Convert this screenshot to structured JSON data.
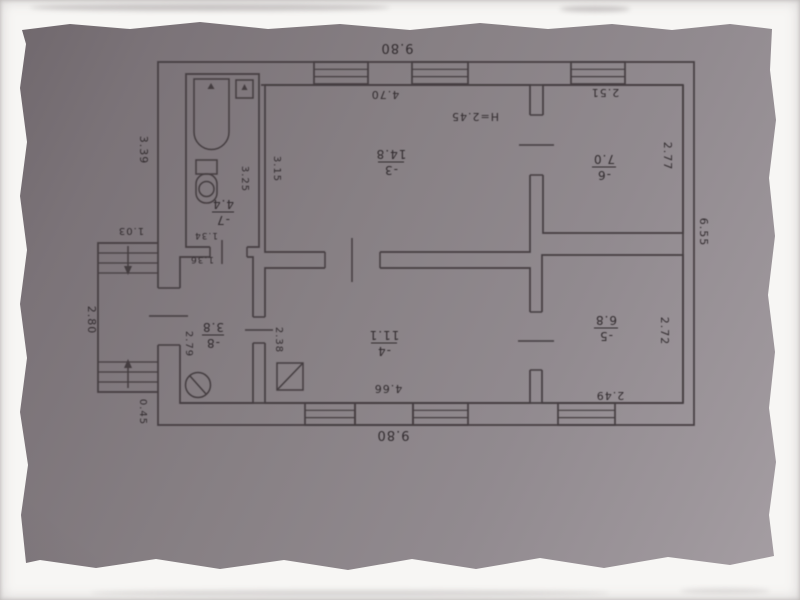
{
  "photo": {
    "border_color": "#f7f6f4",
    "paper_color": "#8a8287",
    "ink_color": "#453e41"
  },
  "floorplan": {
    "height_note": "H=2.45",
    "outer_dimensions": {
      "top": "9.80",
      "bottom": "9.80",
      "right": "6.55",
      "left": "3.39"
    },
    "porch": {
      "width": "1.03",
      "depth": "2.80",
      "step": "0.45"
    },
    "rooms": [
      {
        "number": "-3",
        "area": "14.8",
        "width": "4.70",
        "depth": "3.15"
      },
      {
        "number": "-4",
        "area": "11.1",
        "width": "4.66",
        "depth": "2.38"
      },
      {
        "number": "-5",
        "area": "6.8",
        "width": "2.49",
        "depth": "2.72"
      },
      {
        "number": "-6",
        "area": "7.0",
        "width": "2.51",
        "depth": "2.77"
      },
      {
        "number": "-7",
        "area": "4.4",
        "width": "1.34",
        "depth": "3.25"
      },
      {
        "number": "-8",
        "area": "3.8",
        "width": "1.36",
        "depth": "2.79"
      }
    ]
  }
}
